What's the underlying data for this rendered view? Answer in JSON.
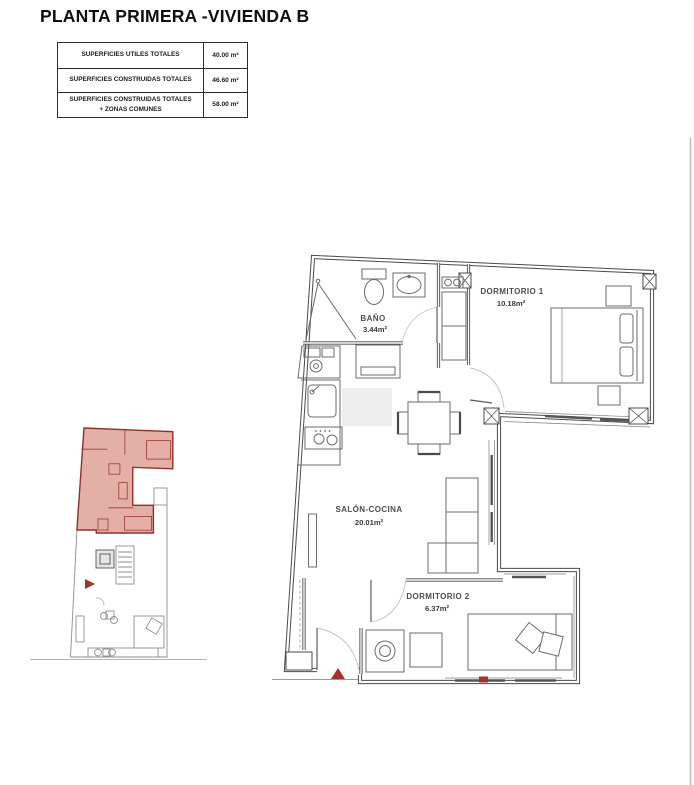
{
  "page": {
    "background": "#ffffff"
  },
  "header": {
    "title": "PLANTA PRIMERA -VIVIENDA B"
  },
  "surfaces_table": {
    "rows": [
      {
        "label": "SUPERFICIES UTILES TOTALES",
        "value": "40.00 m²"
      },
      {
        "label": "SUPERFICIES CONSTRUIDAS TOTALES",
        "value": "46.60 m²"
      },
      {
        "label": "SUPERFICIES CONSTRUIDAS TOTALES + ZONAS COMUNES",
        "value": "58.00 m²"
      }
    ]
  },
  "floor_plan": {
    "rooms": [
      {
        "name": "BAÑO",
        "area": "3.44m²"
      },
      {
        "name": "DORMITORIO 1",
        "area": "10.18m²"
      },
      {
        "name": "SALÓN-COCINA",
        "area": "20.01m²"
      },
      {
        "name": "DORMITORIO 2",
        "area": "6.37m²"
      }
    ],
    "entrance_marker_color": "#a3322a",
    "highlight_fill": "#cb6557",
    "highlight_outline": "#8f3028",
    "line_color": "#4a4a4a"
  }
}
